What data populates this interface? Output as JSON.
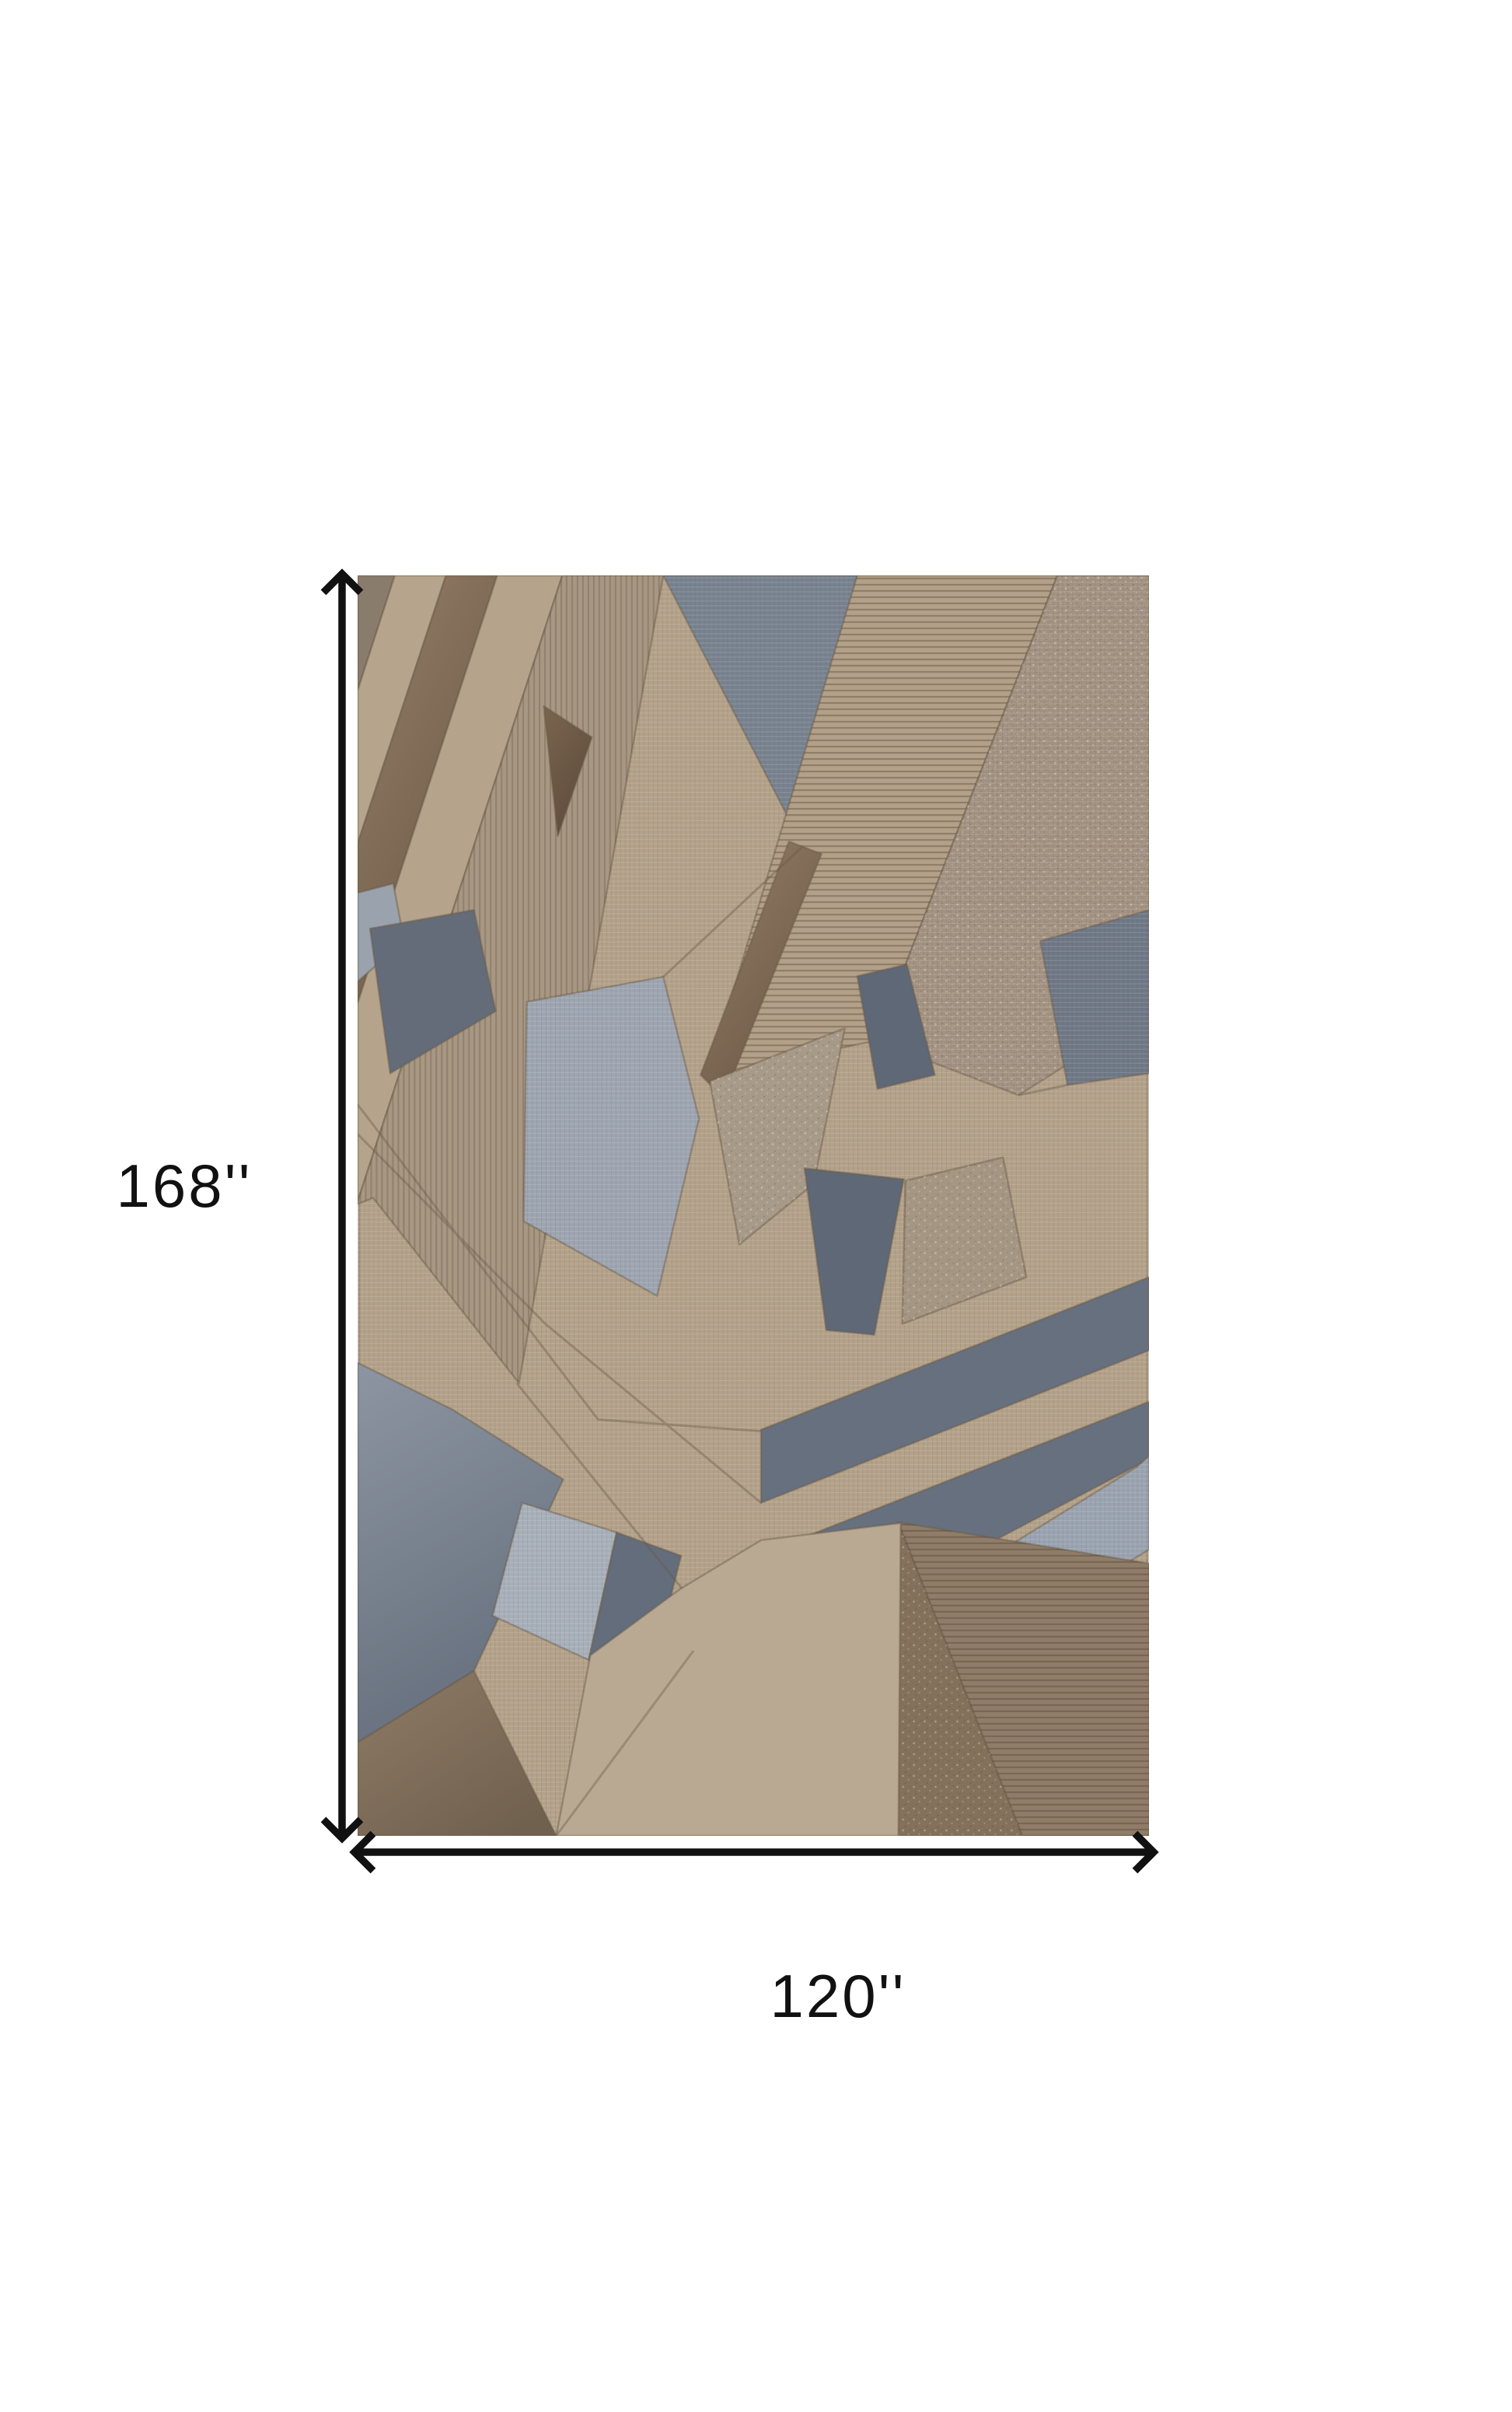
{
  "diagram": {
    "height_label": "168''",
    "width_label": "120''",
    "arrow_color": "#111111",
    "background_color": "#ffffff"
  },
  "rug": {
    "description": "abstract geometric patchwork area rug",
    "palette": {
      "tan": "#B3A189",
      "taupe_stripe": "#8A7C6D",
      "velvet_brown": "#6F5C4A",
      "corduroy_taupe": "#A89883",
      "slate_blue": "#67707E",
      "gray_blue": "#78828F",
      "pale_gray_blue": "#9DA5B1",
      "heather_taupe": "#A39282",
      "dark_taupe": "#84715C",
      "ribbed_brown": "#8F7D69",
      "beige": "#B9A993"
    }
  }
}
